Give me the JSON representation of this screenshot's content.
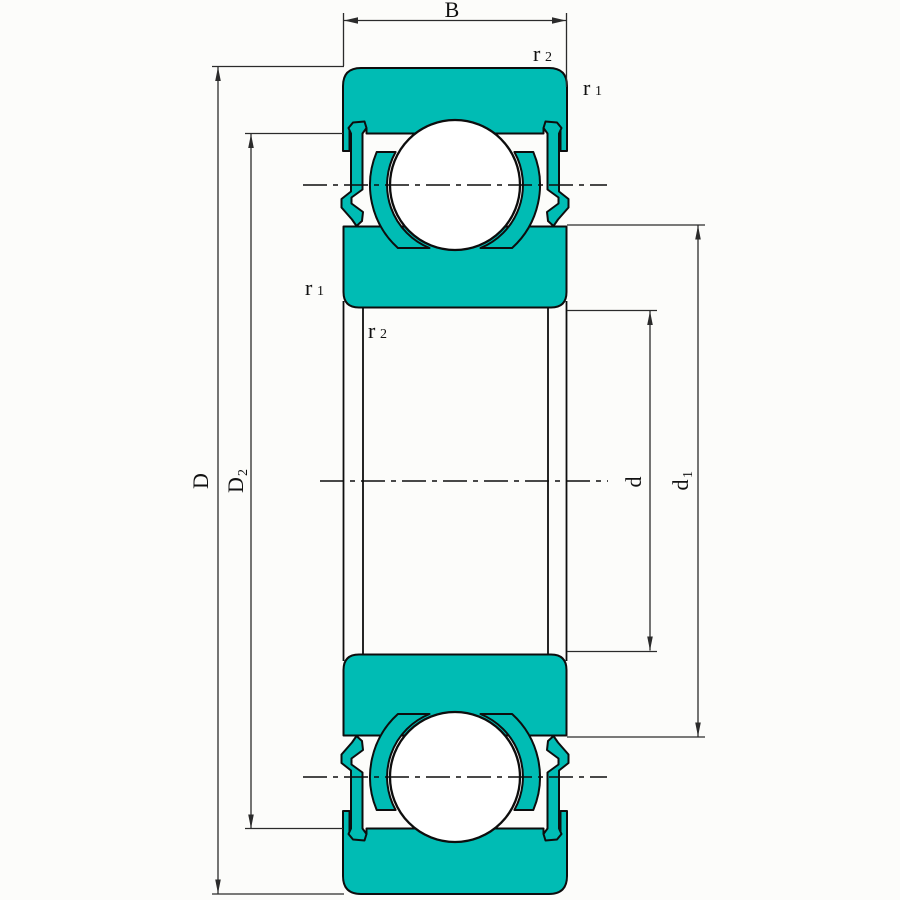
{
  "drawing_labels": {
    "b": {
      "text": "B"
    },
    "D": {
      "text": "D"
    },
    "D2": {
      "text": "D",
      "sub": "2"
    },
    "d": {
      "text": "d"
    },
    "d1": {
      "text": "d",
      "sub": "1"
    },
    "r2_top": {
      "text": "r",
      "sub": "2"
    },
    "r1_top": {
      "text": "r",
      "sub": "1"
    },
    "r1_left": {
      "text": "r",
      "sub": "1"
    },
    "r2_left": {
      "text": "r",
      "sub": "2"
    }
  },
  "colors": {
    "bearing_fill": "#00BCB4",
    "outline": "#0D0D0D",
    "dim_line": "#2B2B2B",
    "background": "#FCFCFA"
  }
}
